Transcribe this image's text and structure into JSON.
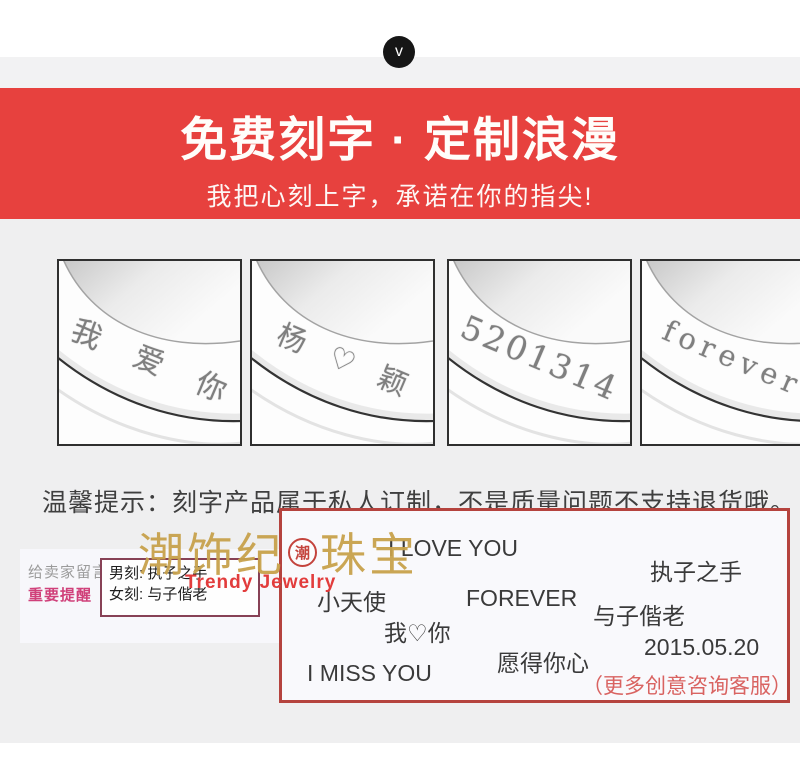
{
  "header": {
    "collapse_icon": "v"
  },
  "banner": {
    "title": "免费刻字 · 定制浪漫",
    "subtitle": "我把心刻上字，承诺在你的指尖!",
    "bg_color": "#e7413e",
    "text_color": "#fffdfa"
  },
  "engraving_samples": [
    {
      "text": "我 爱 你"
    },
    {
      "text": "杨 ♡ 颖"
    },
    {
      "text": "5201314"
    },
    {
      "text": "forever"
    }
  ],
  "notice": {
    "text": "温馨提示：刻字产品属于私人订制，不是质量问题不支持退货哦。"
  },
  "message_panel": {
    "label": "给卖家留言:",
    "warning": "重要提醒",
    "line_male": "男刻: 执子之手",
    "line_female": "女刻: 与子偕老"
  },
  "watermark": {
    "brand_left": "潮饰纪",
    "seal_char": "潮",
    "brand_right": "珠宝",
    "english": "Trendy Jewelry",
    "gold_color": "#c8a24c",
    "red_color": "#e23c3c"
  },
  "ideas_box": {
    "phrases": [
      {
        "text": "I LOVE YOU"
      },
      {
        "text": "执子之手"
      },
      {
        "text": "小天使"
      },
      {
        "text": "FOREVER"
      },
      {
        "text": "与子偕老"
      },
      {
        "text": "我♡你"
      },
      {
        "text": "2015.05.20"
      },
      {
        "text": "愿得你心"
      },
      {
        "text": "I MISS YOU"
      }
    ],
    "note": "（更多创意咨询客服）",
    "border_color": "#b5433e",
    "note_color": "#d96361"
  }
}
